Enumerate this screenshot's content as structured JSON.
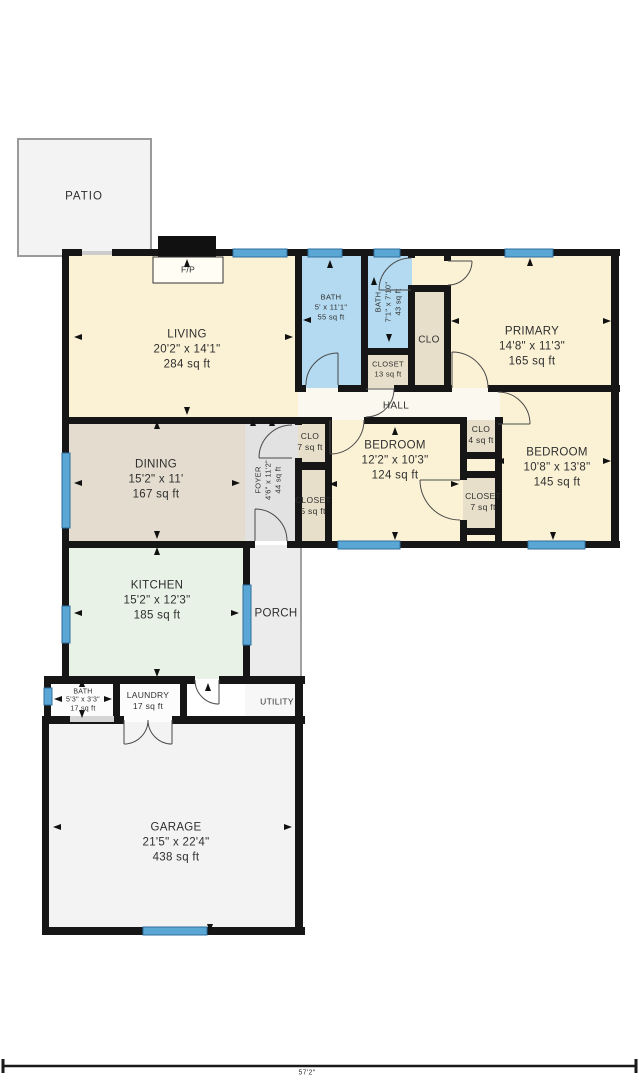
{
  "plan_title": "floor-plan",
  "colors": {
    "wall": "#161616",
    "window_blue": "#5aa7d6",
    "room_cream": "#fbf2d6",
    "room_bath_blue": "#b3daf0",
    "room_dining_tan": "#e3dccf",
    "room_closet_tan": "#e8dfca",
    "room_kitchen_green": "#e9f2e7",
    "room_foyer_gray": "#e2e2e2",
    "room_porch_gray": "#ececec",
    "room_garage_gray": "#f3f3f3",
    "hall_white": "#fbf9ef"
  },
  "rooms": {
    "patio": {
      "label": "PATIO"
    },
    "living": {
      "label": "LIVING",
      "dims": "20'2\" x 14'1\"",
      "area": "284 sq ft"
    },
    "fireplace": {
      "label": "F/P"
    },
    "bath_top": {
      "label": "BATH",
      "dims": "5' x 11'1\"",
      "area": "55 sq ft"
    },
    "bath_mid": {
      "label": "BATH",
      "dims": "7'1\" x 7'10\"",
      "area": "43 sq ft"
    },
    "closet_13": {
      "label": "CLOSET",
      "area": "13 sq ft"
    },
    "clo_primary": {
      "label": "CLO"
    },
    "primary": {
      "label": "PRIMARY",
      "dims": "14'8\" x 11'3\"",
      "area": "165 sq ft"
    },
    "hall": {
      "label": "HALL"
    },
    "clo_7": {
      "label": "CLO",
      "area": "7 sq ft"
    },
    "closet_5": {
      "label": "CLOSET",
      "area": "5 sq ft"
    },
    "bedroom_mid": {
      "label": "BEDROOM",
      "dims": "12'2\" x 10'3\"",
      "area": "124 sq ft"
    },
    "clo_4": {
      "label": "CLO",
      "area": "4 sq ft"
    },
    "closet_7": {
      "label": "CLOSET",
      "area": "7 sq ft"
    },
    "bedroom_right": {
      "label": "BEDROOM",
      "dims": "10'8\" x 13'8\"",
      "area": "145 sq ft"
    },
    "dining": {
      "label": "DINING",
      "dims": "15'2\" x 11'",
      "area": "167 sq ft"
    },
    "foyer": {
      "label": "FOYER",
      "dims": "4'6\" x 11'2\"",
      "area": "44 sq ft"
    },
    "kitchen": {
      "label": "KITCHEN",
      "dims": "15'2\" x 12'3\"",
      "area": "185 sq ft"
    },
    "porch": {
      "label": "PORCH"
    },
    "utility": {
      "label": "UTILITY"
    },
    "bath_garage": {
      "label": "BATH",
      "dims": "5'3\" x 3'3\"",
      "area": "17 sq ft"
    },
    "laundry": {
      "label": "LAUNDRY",
      "area": "17 sq ft"
    },
    "garage": {
      "label": "GARAGE",
      "dims": "21'5\" x 22'4\"",
      "area": "438 sq ft"
    }
  },
  "scale_bar": {
    "label": "57'2\""
  }
}
